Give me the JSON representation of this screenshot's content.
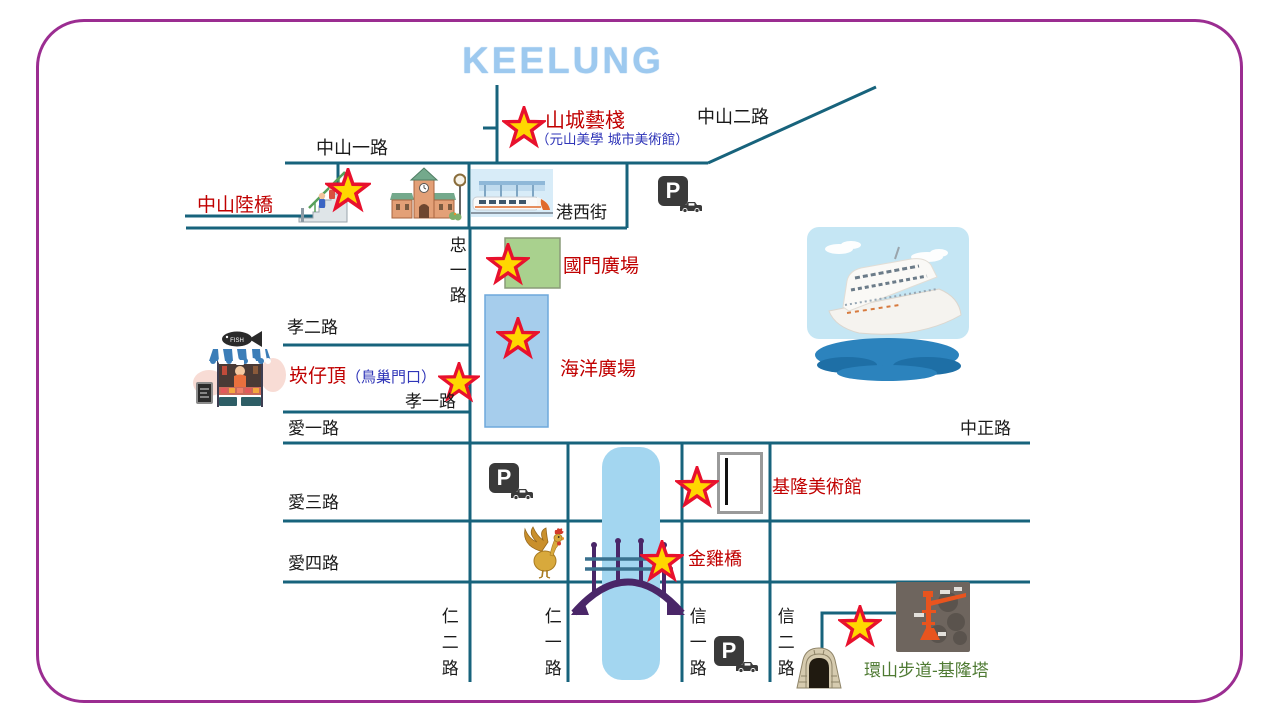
{
  "title": "KEELUNG",
  "roads": {
    "zhongshan1": "中山一路",
    "zhongshan2": "中山二路",
    "zhongyi": "忠一路",
    "xiao2": "孝二路",
    "xiao1": "孝一路",
    "ai1": "愛一路",
    "ai3": "愛三路",
    "ai4": "愛四路",
    "ren2": "仁二路",
    "ren1": "仁一路",
    "xin1": "信一路",
    "xin2": "信二路",
    "zhongzheng": "中正路",
    "gangxi": "港西街"
  },
  "pois": {
    "shancheng_name": "山城藝棧",
    "shancheng_sub": "（元山美學 城市美術館）",
    "zhongshan_overpass": "中山陸橋",
    "guomen_plaza": "國門廣場",
    "kanzaiding_name": "崁仔頂",
    "kanzaiding_sub": "（鳥巢門口）",
    "ocean_plaza": "海洋廣場",
    "keelung_art_museum": "基隆美術館",
    "golden_rooster_bridge": "金雞橋",
    "mountain_trail_tower": "環山步道-基隆塔"
  },
  "icons": {
    "parking_letter": "P",
    "fish_sign": "FISH"
  },
  "colors": {
    "border_purple": "#9B2D91",
    "road_teal": "#17637C",
    "poi_red": "#C00000",
    "poi_blue": "#2F35B8",
    "poi_green": "#4E7A32",
    "title_blue": "#9DC9EF",
    "star_fill": "#FFD700",
    "star_stroke": "#E8112D",
    "river_blue": "#A3D6F0",
    "plaza_green": "#A9D18E",
    "plaza_blue": "#A6CDEC",
    "bridge_purple": "#4A2668"
  }
}
